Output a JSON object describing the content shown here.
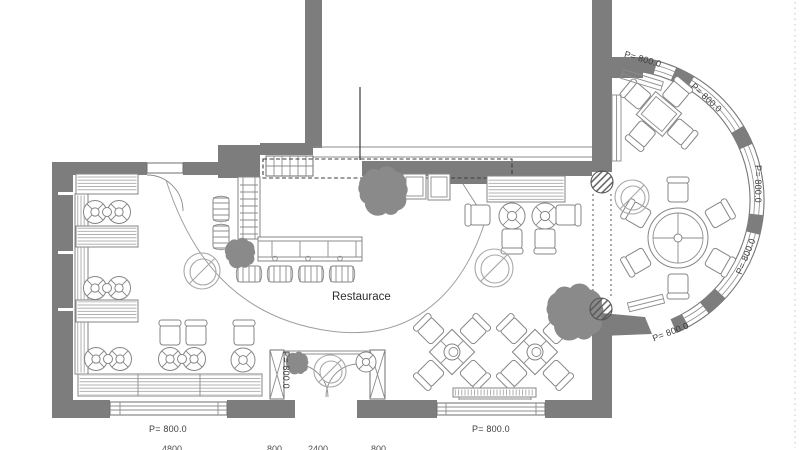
{
  "drawing": {
    "room_label": "Restaurace",
    "labels": {
      "bay_top": "P= 800.0",
      "bay_upper_right": "P= 800.0",
      "bay_right": "P= 800.0",
      "bay_lower_right": "P= 800.0",
      "bay_bottom": "P= 800.0",
      "vestibule_side": "P= 800.0",
      "window_left": "P= 800.0",
      "window_right": "P= 800.0"
    },
    "dimensions": {
      "left_window": "4800",
      "entry_left": "800",
      "entry": "2400",
      "entry_right": "800"
    },
    "colors": {
      "wall": "#7d7d7d",
      "furniture_line": "#8c8c8c",
      "text": "#3d3d3d",
      "plant": "#8a8a8a",
      "background": "#ffffff"
    }
  }
}
